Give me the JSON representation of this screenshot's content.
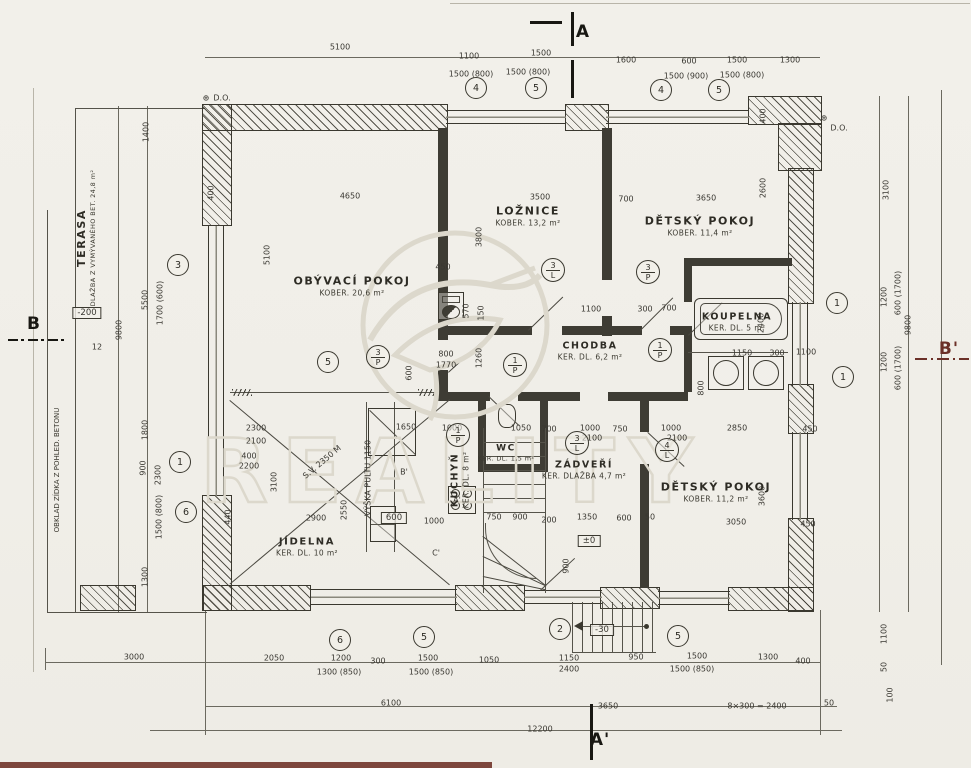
{
  "drawing": {
    "type": "floor-plan",
    "paper_color": "#f1efe9",
    "ink_color": "#3a382f",
    "section_marker_color_red": "#6b3028"
  },
  "rooms": {
    "obyvaci": {
      "name": "OBÝVACÍ POKOJ",
      "sub": "KOBER.  20,6 m²"
    },
    "loznice": {
      "name": "LOŽNICE",
      "sub": "KOBER.  13,2 m²"
    },
    "detsky1": {
      "name": "DĚTSKÝ  POKOJ",
      "sub": "KOBER.  11,4 m²"
    },
    "koupelna": {
      "name": "KOUPELNA",
      "sub": "KER. DL. 5 m²"
    },
    "chodba": {
      "name": "CHODBA",
      "sub": "KER. DL. 6,2 m²"
    },
    "jidelna": {
      "name": "JÍDELNA",
      "sub": "KER. DL. 10 m²"
    },
    "kuchyn": {
      "name": "KUCHYŇ",
      "sub": "KER. DL. 8 m²"
    },
    "wc": {
      "name": "WC",
      "sub": "KER. DL. 1,5 m²"
    },
    "zadveri": {
      "name": "ZÁDVEŘÍ",
      "sub": "KER. DLAŽBA 4,7 m²"
    },
    "detsky2": {
      "name": "DĚTSKÝ  POKOJ",
      "sub": "KOBER.  11,2 m²"
    },
    "terasa": {
      "name": "TERASA",
      "sub": "DLAŽBA Z VYMÝVANÉHO BET. 24,8 m²"
    }
  },
  "markers": {
    "a": "A",
    "a_prime": "A'",
    "b": "B",
    "b_prime": "B'"
  },
  "notes": {
    "obklad": "OBKLAD ZÍDKA Z POHLED. BETONU",
    "slope": "12"
  },
  "watermark": {
    "text": "REALITY"
  },
  "boxes": [
    {
      "t": "-200",
      "x": 87,
      "y": 313
    },
    {
      "t": "±0",
      "x": 589,
      "y": 541
    },
    {
      "t": "-30",
      "x": 602,
      "y": 630
    },
    {
      "t": "600",
      "x": 394,
      "y": 518
    }
  ],
  "circles": [
    {
      "n": "4",
      "x": 476,
      "y": 88
    },
    {
      "n": "5",
      "x": 536,
      "y": 88
    },
    {
      "n": "4",
      "x": 661,
      "y": 90
    },
    {
      "n": "5",
      "x": 719,
      "y": 90
    },
    {
      "n": "3",
      "x": 178,
      "y": 265
    },
    {
      "n": "1",
      "x": 180,
      "y": 462
    },
    {
      "n": "6",
      "x": 186,
      "y": 512
    },
    {
      "n": "1",
      "x": 837,
      "y": 303
    },
    {
      "n": "1",
      "x": 843,
      "y": 377
    },
    {
      "n": "6",
      "x": 340,
      "y": 640
    },
    {
      "n": "5",
      "x": 424,
      "y": 637
    },
    {
      "n": "2",
      "x": 560,
      "y": 629
    },
    {
      "n": "5",
      "x": 678,
      "y": 636
    },
    {
      "n": "5",
      "x": 328,
      "y": 362
    }
  ],
  "circles2": [
    {
      "a": "3",
      "b": "P",
      "x": 378,
      "y": 357
    },
    {
      "a": "3",
      "b": "L",
      "x": 553,
      "y": 270
    },
    {
      "a": "3",
      "b": "P",
      "x": 648,
      "y": 272
    },
    {
      "a": "1",
      "b": "P",
      "x": 515,
      "y": 365
    },
    {
      "a": "1",
      "b": "P",
      "x": 660,
      "y": 350
    },
    {
      "a": "3",
      "b": "L",
      "x": 577,
      "y": 443
    },
    {
      "a": "1",
      "b": "P",
      "x": 458,
      "y": 435
    },
    {
      "a": "4",
      "b": "L",
      "x": 667,
      "y": 450
    }
  ],
  "dims": [
    {
      "t": "5100",
      "x": 340,
      "y": 47
    },
    {
      "t": "1100",
      "x": 469,
      "y": 56
    },
    {
      "t": "1500",
      "x": 541,
      "y": 53
    },
    {
      "t": "1600",
      "x": 626,
      "y": 60
    },
    {
      "t": "600",
      "x": 689,
      "y": 61
    },
    {
      "t": "1500",
      "x": 737,
      "y": 60
    },
    {
      "t": "1300",
      "x": 790,
      "y": 60
    },
    {
      "t": "1500 (800)",
      "x": 471,
      "y": 74
    },
    {
      "t": "1500 (800)",
      "x": 528,
      "y": 72
    },
    {
      "t": "1500 (900)",
      "x": 686,
      "y": 76
    },
    {
      "t": "1500 (800)",
      "x": 742,
      "y": 75
    },
    {
      "t": "1400",
      "x": 146,
      "y": 132,
      "r": -90
    },
    {
      "t": "5500",
      "x": 145,
      "y": 300,
      "r": -90
    },
    {
      "t": "1700 (600)",
      "x": 160,
      "y": 303,
      "r": -90
    },
    {
      "t": "1800",
      "x": 145,
      "y": 430,
      "r": -90
    },
    {
      "t": "900",
      "x": 143,
      "y": 468,
      "r": -90
    },
    {
      "t": "2300",
      "x": 158,
      "y": 475,
      "r": -90
    },
    {
      "t": "1500 (800)",
      "x": 159,
      "y": 517,
      "r": -90
    },
    {
      "t": "1300",
      "x": 145,
      "y": 577,
      "r": -90
    },
    {
      "t": "9800",
      "x": 119,
      "y": 330,
      "r": -90
    },
    {
      "t": "3100",
      "x": 886,
      "y": 190,
      "r": -90
    },
    {
      "t": "1200",
      "x": 884,
      "y": 297,
      "r": -90
    },
    {
      "t": "600 (1700)",
      "x": 898,
      "y": 293,
      "r": -90
    },
    {
      "t": "9800",
      "x": 908,
      "y": 325,
      "r": -90
    },
    {
      "t": "1200",
      "x": 884,
      "y": 362,
      "r": -90
    },
    {
      "t": "600 (1700)",
      "x": 898,
      "y": 368,
      "r": -90
    },
    {
      "t": "1100",
      "x": 884,
      "y": 634,
      "r": -90
    },
    {
      "t": "50",
      "x": 884,
      "y": 667,
      "r": -90
    },
    {
      "t": "100",
      "x": 890,
      "y": 695,
      "r": -90
    },
    {
      "t": "400",
      "x": 763,
      "y": 116,
      "r": -90
    },
    {
      "t": "3000",
      "x": 134,
      "y": 657
    },
    {
      "t": "2050",
      "x": 274,
      "y": 658
    },
    {
      "t": "1200",
      "x": 341,
      "y": 658
    },
    {
      "t": "300",
      "x": 378,
      "y": 661
    },
    {
      "t": "1500",
      "x": 428,
      "y": 658
    },
    {
      "t": "1050",
      "x": 489,
      "y": 660
    },
    {
      "t": "1150",
      "x": 569,
      "y": 658
    },
    {
      "t": "950",
      "x": 636,
      "y": 657
    },
    {
      "t": "1500",
      "x": 697,
      "y": 656
    },
    {
      "t": "1300",
      "x": 768,
      "y": 657
    },
    {
      "t": "400",
      "x": 803,
      "y": 661
    },
    {
      "t": "1300 (850)",
      "x": 339,
      "y": 672
    },
    {
      "t": "1500 (850)",
      "x": 431,
      "y": 672
    },
    {
      "t": "2400",
      "x": 569,
      "y": 669
    },
    {
      "t": "1500 (850)",
      "x": 692,
      "y": 669
    },
    {
      "t": "6100",
      "x": 391,
      "y": 703
    },
    {
      "t": "3650",
      "x": 608,
      "y": 706
    },
    {
      "t": "8×300 = 2400",
      "x": 757,
      "y": 706
    },
    {
      "t": "50",
      "x": 829,
      "y": 703
    },
    {
      "t": "12200",
      "x": 540,
      "y": 729
    },
    {
      "t": "12",
      "x": 97,
      "y": 347
    },
    {
      "t": "4650",
      "x": 350,
      "y": 196
    },
    {
      "t": "5100",
      "x": 267,
      "y": 255,
      "r": -90
    },
    {
      "t": "400",
      "x": 211,
      "y": 193,
      "r": -90
    },
    {
      "t": "3500",
      "x": 540,
      "y": 197
    },
    {
      "t": "3800",
      "x": 479,
      "y": 237,
      "r": -90
    },
    {
      "t": "700",
      "x": 626,
      "y": 199
    },
    {
      "t": "3650",
      "x": 706,
      "y": 198
    },
    {
      "t": "2600",
      "x": 763,
      "y": 188,
      "r": -90
    },
    {
      "t": "1100",
      "x": 591,
      "y": 309
    },
    {
      "t": "300",
      "x": 645,
      "y": 309
    },
    {
      "t": "700",
      "x": 669,
      "y": 308
    },
    {
      "t": "450",
      "x": 443,
      "y": 267
    },
    {
      "t": "570",
      "x": 466,
      "y": 311,
      "r": -90
    },
    {
      "t": "150",
      "x": 481,
      "y": 313,
      "r": -90
    },
    {
      "t": "1260",
      "x": 479,
      "y": 358,
      "r": -90
    },
    {
      "t": "800",
      "x": 446,
      "y": 354
    },
    {
      "t": "1770",
      "x": 446,
      "y": 365
    },
    {
      "t": "600",
      "x": 409,
      "y": 373,
      "r": -90
    },
    {
      "t": "2400",
      "x": 761,
      "y": 323,
      "r": -90
    },
    {
      "t": "1150",
      "x": 742,
      "y": 353
    },
    {
      "t": "300",
      "x": 777,
      "y": 353
    },
    {
      "t": "1100",
      "x": 806,
      "y": 352
    },
    {
      "t": "800",
      "x": 701,
      "y": 388,
      "r": -90
    },
    {
      "t": "1000",
      "x": 452,
      "y": 428
    },
    {
      "t": "1050",
      "x": 521,
      "y": 428
    },
    {
      "t": "700",
      "x": 549,
      "y": 429
    },
    {
      "t": "1000",
      "x": 590,
      "y": 428
    },
    {
      "t": "750",
      "x": 620,
      "y": 429
    },
    {
      "t": "2100",
      "x": 592,
      "y": 438
    },
    {
      "t": "750",
      "x": 494,
      "y": 517
    },
    {
      "t": "900",
      "x": 520,
      "y": 517
    },
    {
      "t": "200",
      "x": 549,
      "y": 520
    },
    {
      "t": "1350",
      "x": 587,
      "y": 517
    },
    {
      "t": "600",
      "x": 624,
      "y": 518
    },
    {
      "t": "50",
      "x": 650,
      "y": 517
    },
    {
      "t": "900",
      "x": 566,
      "y": 566,
      "r": -90
    },
    {
      "t": "2300",
      "x": 256,
      "y": 428
    },
    {
      "t": "2100",
      "x": 256,
      "y": 441
    },
    {
      "t": "1650",
      "x": 406,
      "y": 427
    },
    {
      "t": "3100",
      "x": 274,
      "y": 482,
      "r": -90
    },
    {
      "t": "2550",
      "x": 344,
      "y": 510,
      "r": -90
    },
    {
      "t": "2900",
      "x": 316,
      "y": 518
    },
    {
      "t": "440",
      "x": 228,
      "y": 517,
      "r": -90
    },
    {
      "t": "400",
      "x": 249,
      "y": 456
    },
    {
      "t": "2200",
      "x": 249,
      "y": 466
    },
    {
      "t": "1000",
      "x": 434,
      "y": 521
    },
    {
      "t": "1000",
      "x": 671,
      "y": 428
    },
    {
      "t": "2100",
      "x": 677,
      "y": 438
    },
    {
      "t": "2850",
      "x": 737,
      "y": 428
    },
    {
      "t": "450",
      "x": 810,
      "y": 429
    },
    {
      "t": "3600",
      "x": 762,
      "y": 496,
      "r": -90
    },
    {
      "t": "3050",
      "x": 736,
      "y": 522
    },
    {
      "t": "450",
      "x": 808,
      "y": 524
    },
    {
      "t": "B'",
      "x": 404,
      "y": 472
    },
    {
      "t": "A'",
      "x": 457,
      "y": 500
    },
    {
      "t": "C'",
      "x": 436,
      "y": 553
    },
    {
      "t": "S.V. 2350 M",
      "x": 322,
      "y": 462,
      "r": -40
    },
    {
      "t": "VÝŠKA PULTU 1150",
      "x": 368,
      "y": 478,
      "r": -90
    },
    {
      "t": "⊕",
      "x": 206,
      "y": 98
    },
    {
      "t": "D.O.",
      "x": 222,
      "y": 98
    },
    {
      "t": "⊕",
      "x": 824,
      "y": 118
    },
    {
      "t": "D.O.",
      "x": 839,
      "y": 128
    }
  ]
}
